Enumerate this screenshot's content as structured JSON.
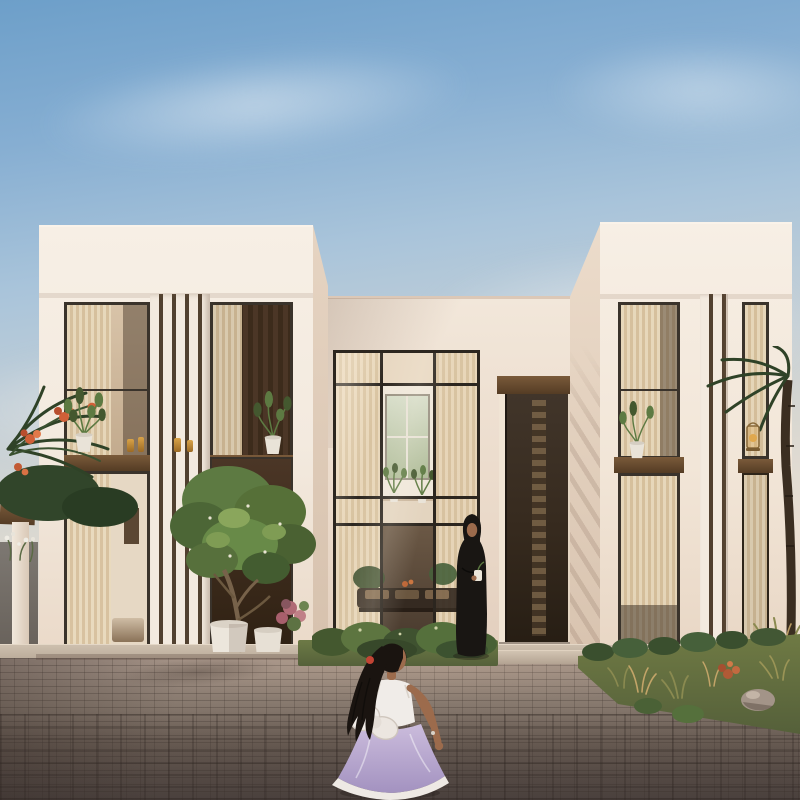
{
  "meta": {
    "type": "architectural-rendering",
    "description": "Modern minimalist two-storey villa at golden hour; a woman in a black abaya stands by the dark timber entrance door while a young girl in a white-and-lavender dress with a large back bow runs across the brick-paved driveway toward her.",
    "width": 800,
    "height": 800
  },
  "palette": {
    "sky_top": "#6d9fc9",
    "sky_mid": "#a9c4da",
    "sky_low": "#d8d7d1",
    "sky_horizon": "#eee1d3",
    "wall_lit": "#f3eadf",
    "wall_bright": "#f7efe5",
    "wall_warm": "#ead9c9",
    "wall_side": "#d8c3af",
    "beam_brown": "#7a5a3a",
    "beam_dark": "#543c24",
    "wood_panel": "#4b3626",
    "wood_panel_dark": "#2f2113",
    "door_wood": "#362a1e",
    "door_slat": "#7a6448",
    "mullion": "#2c261f",
    "glass_warm": "#d8c2a7",
    "glass_deep": "#bfa68a",
    "curtain_light": "#ead9bc",
    "curtain_dark": "#d9c4a1",
    "interior_room": "#e6d8c4",
    "interior_dark": "#46382c",
    "foliage_dark": "#44582f",
    "foliage_mid": "#5d7a42",
    "foliage_light": "#85a258",
    "trunk_brown": "#77624a",
    "palm_dark": "#2f4227",
    "grass_green": "#6d7a46",
    "grass_dark": "#55613a",
    "bed_olive": "#6f7a44",
    "bed_tan": "#c2a468",
    "bed_red": "#b05a36",
    "rock_grey": "#a39488",
    "paving_light": "#a29186",
    "paving_mid": "#87796e",
    "paving_dark": "#5c524e",
    "platform_stone": "#cdbfae",
    "pergola_grey": "#7d7872",
    "skin_tone": "#9c6b4c",
    "hair_black": "#1a1410",
    "abaya_black": "#191613",
    "dress_white": "#f0ece8",
    "dress_lavender": "#b5a3cc",
    "hair_clip_red": "#c24434",
    "flower_orange": "#d06038",
    "flower_pink": "#b06a75",
    "candle_amber": "#d9a348"
  },
  "scene": {
    "sky": {
      "time_of_day": "late afternoon",
      "clouds": 4
    },
    "building": {
      "style": "modern minimalist villa",
      "storeys": 2,
      "left_wing": {
        "fin_screen": true,
        "upper_windows": 2,
        "lower_window": 1,
        "wood_panel_niche": true,
        "sill_plants": 2,
        "candles_on_beam": 4
      },
      "right_wing": {
        "fin_screen": true,
        "upper_windows": 2,
        "lower_windows": 2,
        "sill_plant": 1,
        "lantern_on_beam": true
      },
      "center": {
        "double_height_glass_atrium": true,
        "glass_bays": 3,
        "indoor_plants": 2,
        "interior_bench": true,
        "entrance_door": "dark timber door with slatted glazing strip",
        "entry_steps": 2
      }
    },
    "landscape": {
      "courtyard_tree": 1,
      "tree_planters": 2,
      "pink_flower_shrub": true,
      "shrub_bed_before_atrium": true,
      "right_planting_bed": {
        "ornamental_grasses": true,
        "rock": true,
        "red_plant": true
      },
      "left_pergola": {
        "posts": 1,
        "brown_beam": true,
        "grey_wall": true
      },
      "palms": "left edge with orange blossoms, right edge palm trunk",
      "paving": "grey-brown brick pavers, darker toward foreground"
    },
    "people": {
      "woman": {
        "pose": "standing near entrance facing viewer",
        "clothing": "black abaya and hijab",
        "holding": "small white object"
      },
      "girl": {
        "pose": "running toward house, seen from behind",
        "clothing": "white bodice, lavender skirt, large white back bow",
        "hair": "long dark ponytail with red clip",
        "accessory": "bracelet on right wrist"
      }
    }
  }
}
